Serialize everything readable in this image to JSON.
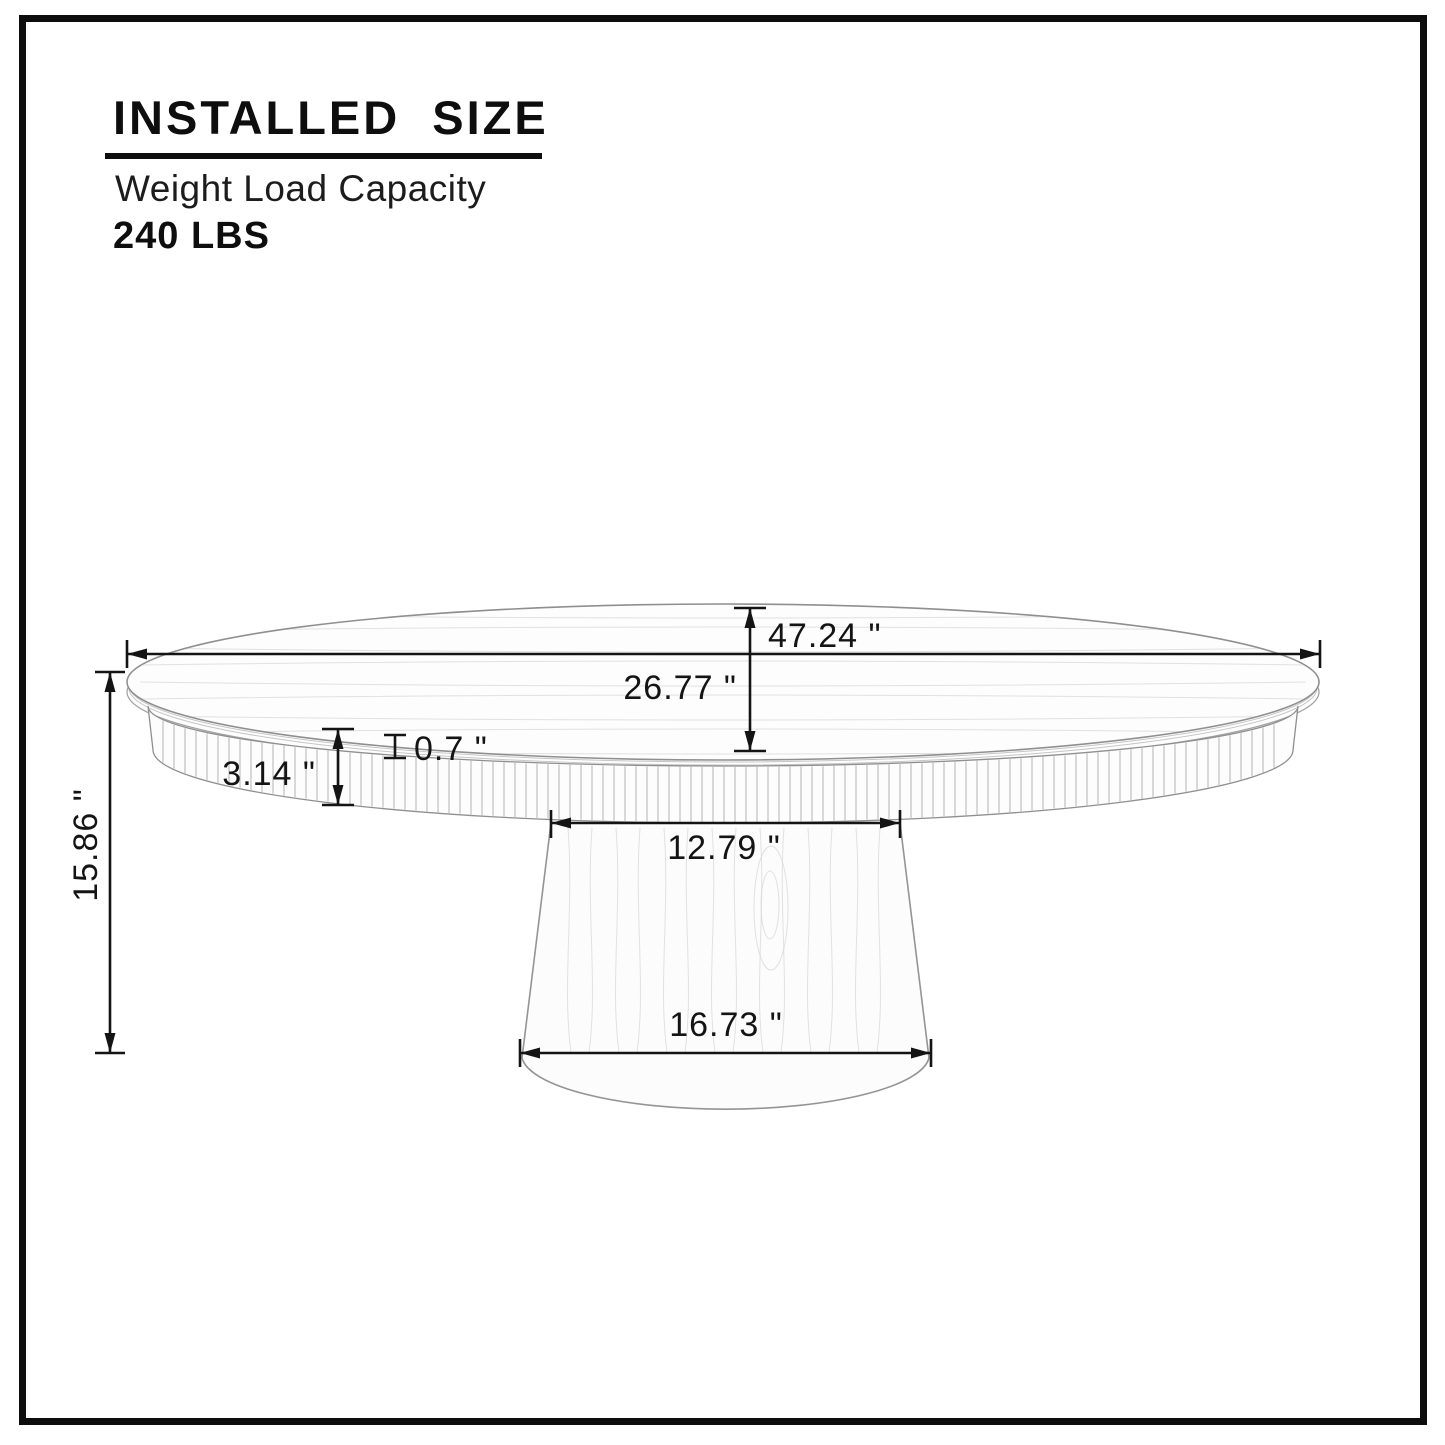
{
  "header": {
    "title": "INSTALLED SIZE",
    "subtitle": "Weight Load Capacity",
    "capacity": "240 LBS"
  },
  "diagram": {
    "dimensions": {
      "top_diameter": "47.24 \"",
      "top_depth": "26.77 \"",
      "overall_height": "15.86 \"",
      "apron_height": "3.14 \"",
      "top_thickness": "0.7 \"",
      "pedestal_top_width": "12.79 \"",
      "pedestal_bottom_width": "16.73 \""
    },
    "colors": {
      "dimension_line": "#141414",
      "outline": "#8f8f8f",
      "flute_line": "#b4b4b4",
      "grain_line": "#d9d9d9",
      "frame": "#0d0d0d"
    }
  }
}
